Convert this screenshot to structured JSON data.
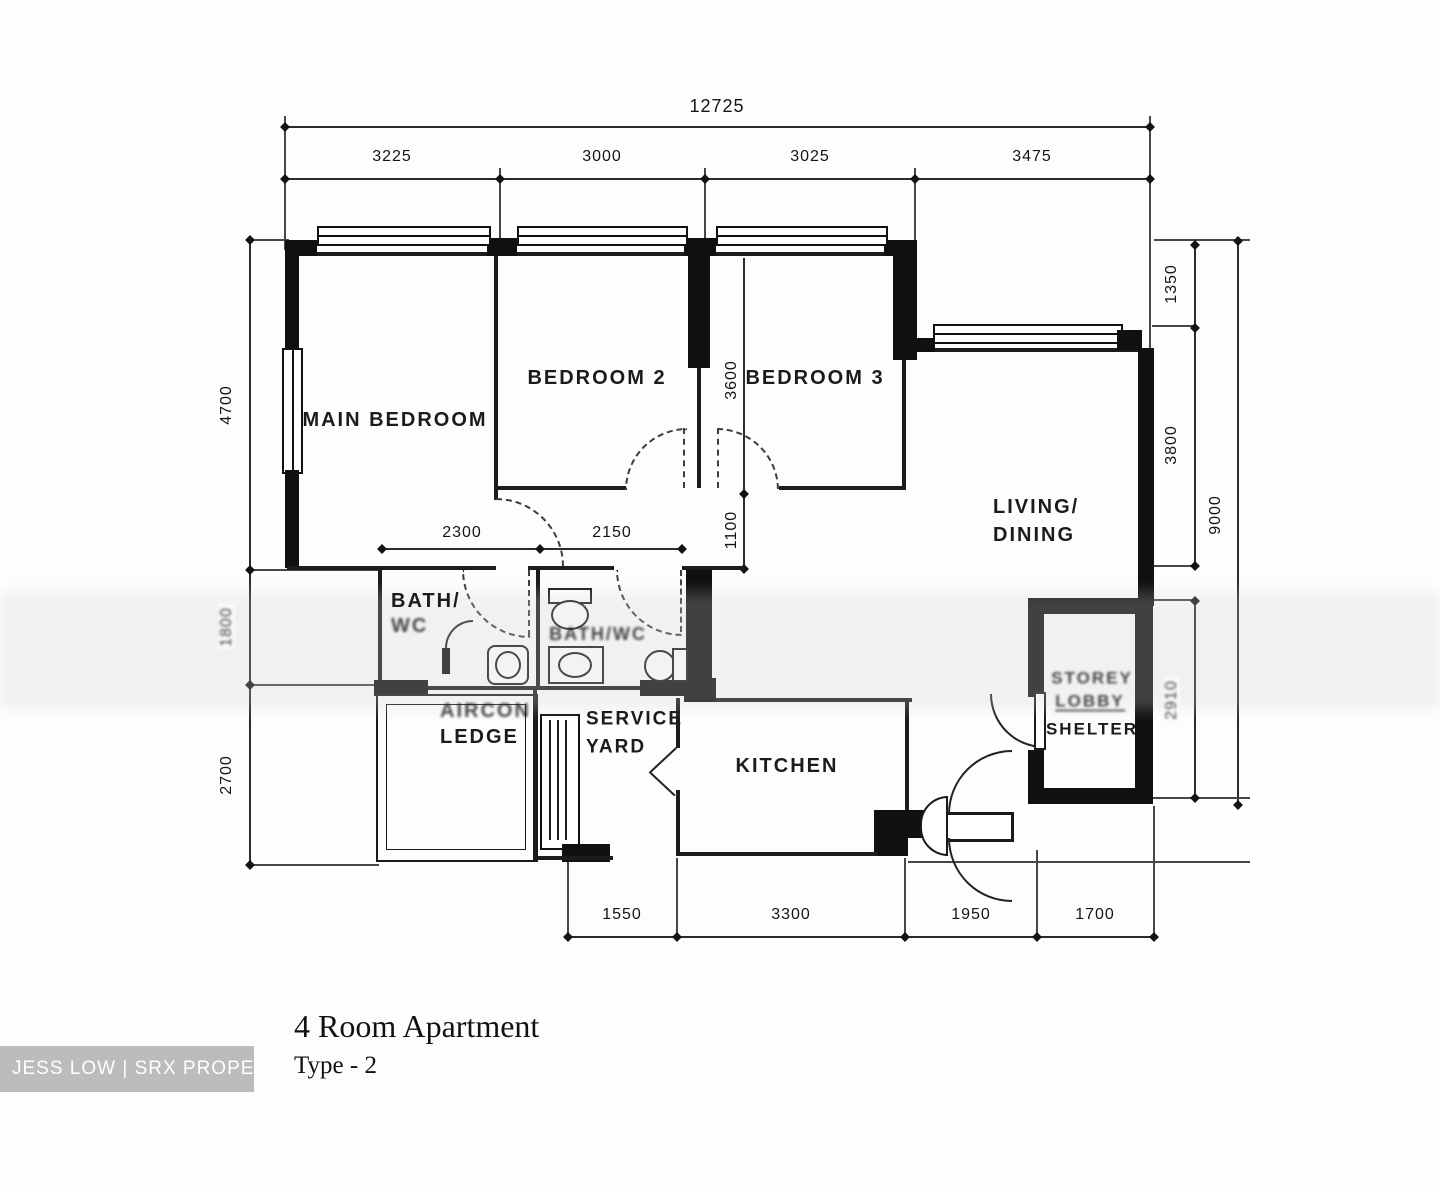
{
  "title": {
    "name": "4 Room Apartment",
    "type": "Type - 2"
  },
  "watermark": "JESS LOW | SRX PROPERTY",
  "rooms": {
    "main_bedroom": "MAIN BEDROOM",
    "bedroom2": "BEDROOM 2",
    "bedroom3": "BEDROOM 3",
    "living1": "LIVING/",
    "living2": "DINING",
    "bath1a": "BATH/",
    "bath1b": "WC",
    "bath2": "BATH/WC",
    "aircon1": "AIRCON",
    "aircon2": "LEDGE",
    "service1": "SERVICE",
    "service2": "YARD",
    "kitchen": "KITCHEN",
    "shelter1": "STOREY",
    "shelter2": "LOBBY",
    "shelter3": "SHELTER"
  },
  "dims": {
    "overall_width": "12725",
    "top": [
      "3225",
      "3000",
      "3025",
      "3475"
    ],
    "left": [
      "4700",
      "1800",
      "2700"
    ],
    "right": [
      "1350",
      "3800",
      "2910"
    ],
    "overall_height": "9000",
    "bottom": [
      "1550",
      "3300",
      "1950",
      "1700"
    ],
    "bath1_width": "2300",
    "bath2_width": "2150",
    "bedroom_wall": "3600",
    "hall_width": "1100"
  }
}
